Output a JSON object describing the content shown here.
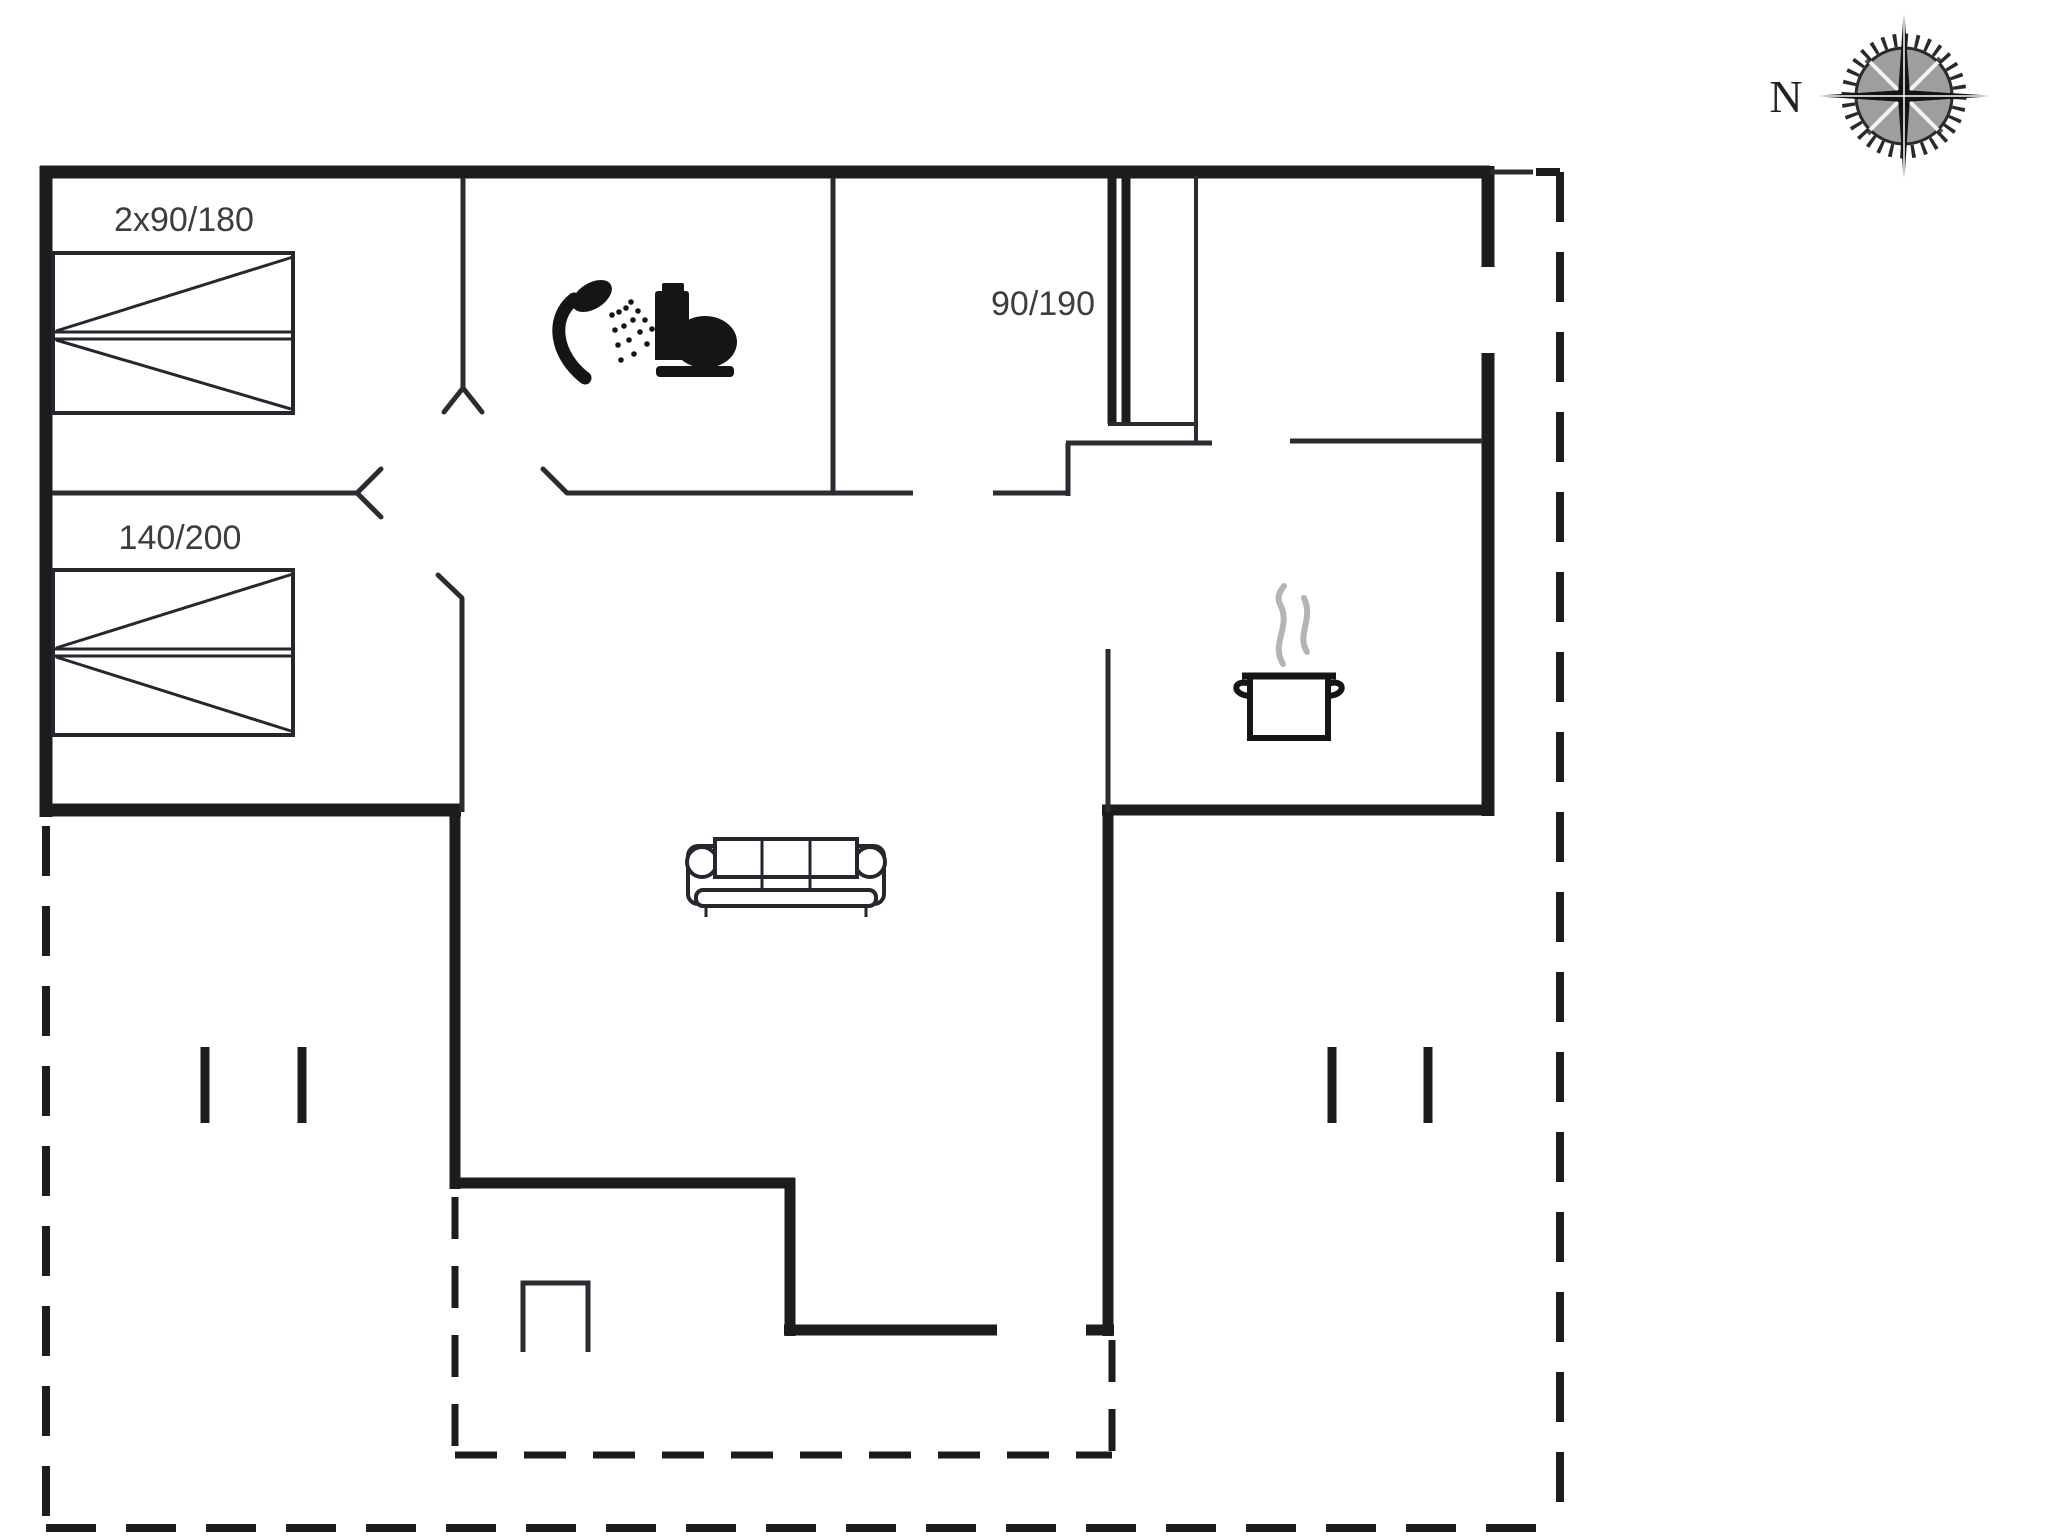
{
  "document": {
    "type": "holiday-home-floor-plan"
  },
  "compass": {
    "north_label": "N"
  },
  "rooms": {
    "bedroom_top_left": {
      "bed_size_label": "2x90/180"
    },
    "bedroom_mid_left": {
      "bed_size_label": "140/200"
    },
    "bedroom_top_middle": {
      "bed_size_label": "90/190"
    }
  },
  "icons": {
    "bathroom": [
      "shower-icon",
      "toilet-icon"
    ],
    "kitchen": [
      "cooking-pot-icon",
      "steam-icon"
    ],
    "living_room": [
      "sofa-icon"
    ],
    "other": [
      "compass-rose-icon",
      "fireplace",
      "terrace-posts"
    ]
  },
  "colors": {
    "wall": "#1c1c1e",
    "thin_line": "#2b2b31",
    "furniture_line": "#26262e",
    "label_text": "#3d3d3d",
    "steam": "#b4b4b4",
    "compass_inner": "#9e9e9e",
    "background": "#ffffff"
  }
}
